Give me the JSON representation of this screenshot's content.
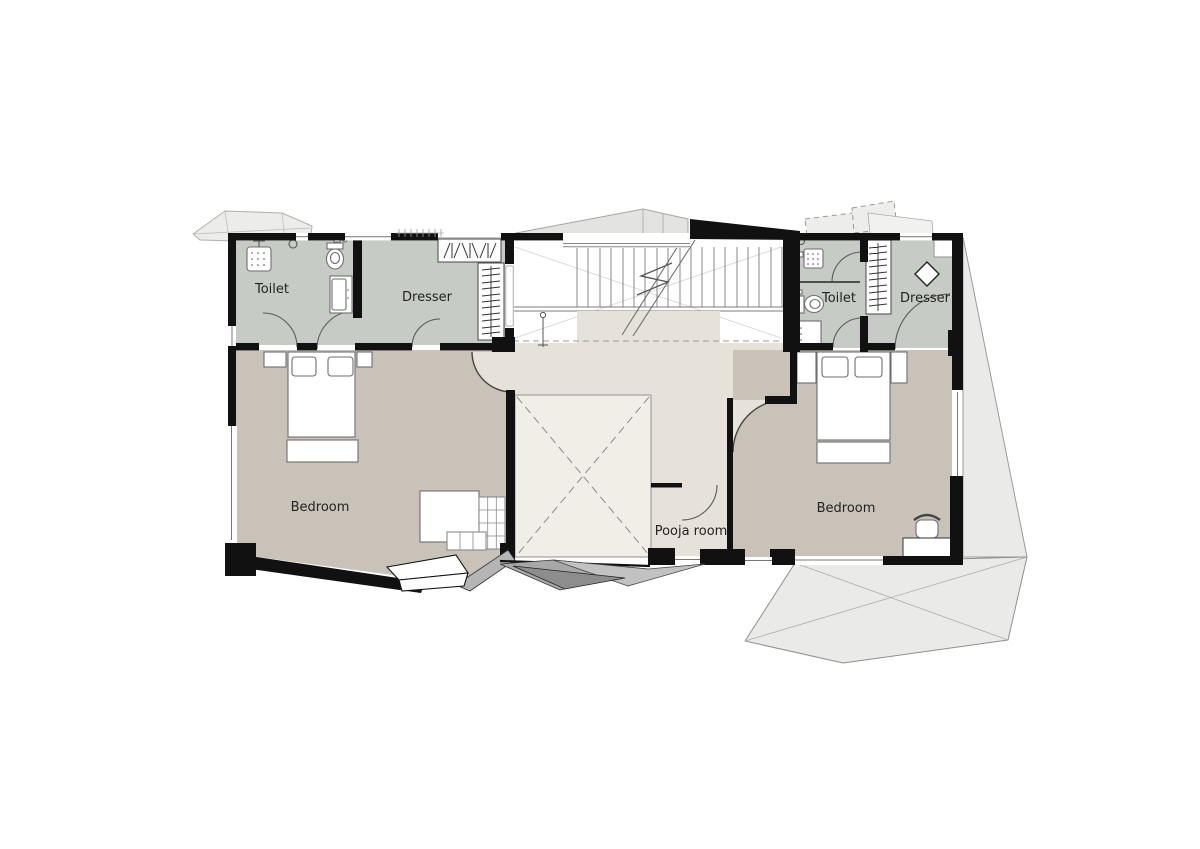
{
  "labels": {
    "toilet_left": "Toilet",
    "dresser_left": "Dresser",
    "bedroom_left": "Bedroom",
    "pooja_room": "Pooja room",
    "toilet_right": "Toilet",
    "dresser_right": "Dresser",
    "bedroom_right": "Bedroom"
  },
  "colors": {
    "wall": "#111111",
    "floor_bedroom": "#c8c2b9",
    "floor_wet": "#c7cbc5",
    "floor_hall": "#e6e2d9",
    "floor_void": "#f0eee7",
    "floor_stair": "#ffffff",
    "roof_light": "#eaebe8",
    "roof_canopy": "#ececea",
    "roof_dark": "#a8a8a8",
    "line": "#555555"
  }
}
